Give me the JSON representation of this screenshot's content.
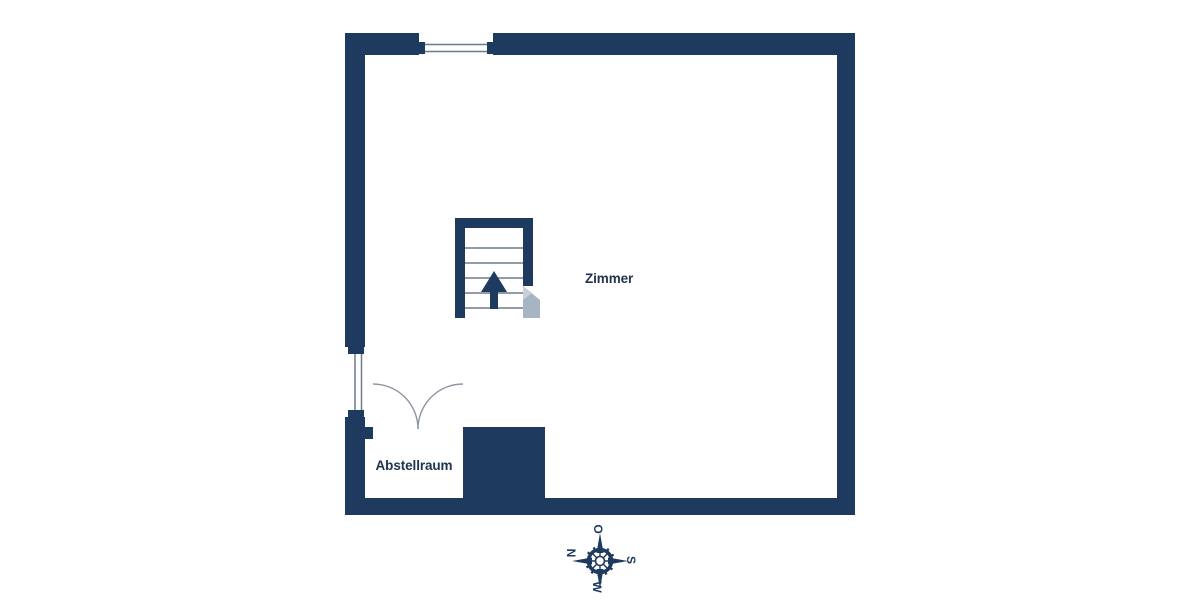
{
  "plan": {
    "title": "floor-plan",
    "rooms": [
      {
        "name": "Zimmer"
      },
      {
        "name": "Abstellraum"
      }
    ],
    "stairs": {
      "arrow_direction": "up"
    },
    "features": {
      "windows": [
        "top-wall-window",
        "left-wall-window"
      ],
      "doors": [
        "double-swing-door-abstellraum"
      ]
    }
  },
  "compass": {
    "top": "O",
    "left": "N",
    "right": "S",
    "bottom": "W"
  },
  "colors": {
    "wall": "#1e3a5e",
    "line": "#6e7b8a",
    "arc": "#8d97a3",
    "text": "#20344e",
    "watermark": "#a7b4c4",
    "watermark_light": "#c9d0d9",
    "background": "#ffffff"
  }
}
